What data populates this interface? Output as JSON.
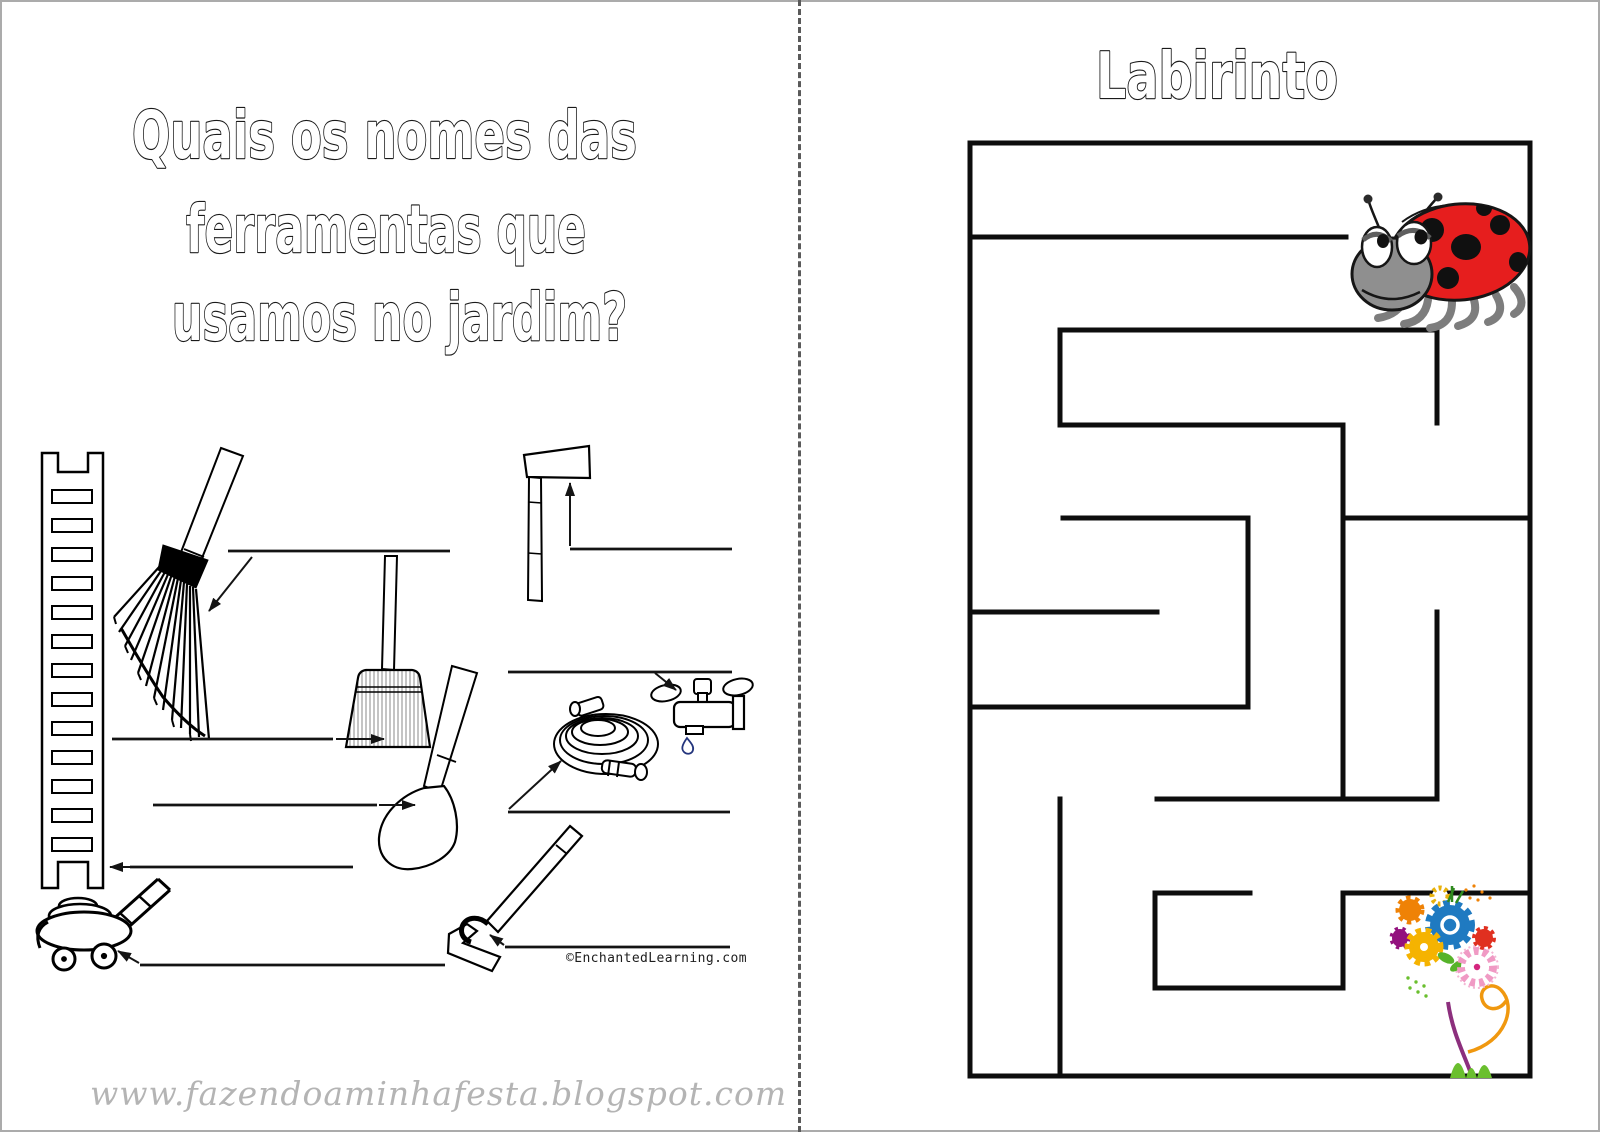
{
  "window": {
    "width": 1600,
    "height": 1132,
    "background": "#ffffff",
    "border_color": "#ababab"
  },
  "left_page": {
    "title_lines": [
      "Quais os nomes das",
      "ferramentas que",
      "usamos no jardim?"
    ],
    "credit": "©EnchantedLearning.com",
    "tools": [
      "ladder",
      "rake",
      "broom",
      "axe",
      "faucet",
      "garden-hose",
      "shovel",
      "lawn-mower",
      "hoe"
    ],
    "answer_lines": [
      {
        "tool": "rake",
        "line": [
          228,
          551,
          450,
          551
        ],
        "arrow": [
          252,
          557,
          209,
          611
        ]
      },
      {
        "tool": "axe",
        "line": [
          570,
          549,
          732,
          549
        ],
        "arrow": [
          570,
          546,
          570,
          483
        ]
      },
      {
        "tool": "faucet",
        "line": [
          508,
          672,
          732,
          672
        ],
        "arrow": [
          655,
          673,
          676,
          690
        ]
      },
      {
        "tool": "broom",
        "line": [
          112,
          739,
          333,
          739
        ],
        "arrow": [
          336,
          739,
          384,
          739
        ]
      },
      {
        "tool": "shovel",
        "line": [
          153,
          805,
          377,
          805
        ],
        "arrow": [
          379,
          805,
          415,
          805
        ]
      },
      {
        "tool": "hose",
        "line": [
          508,
          812,
          730,
          812
        ],
        "arrow": [
          509,
          809,
          561,
          761
        ]
      },
      {
        "tool": "ladder",
        "line": [
          130,
          867,
          353,
          867
        ],
        "arrow": [
          131,
          867,
          110,
          867
        ]
      },
      {
        "tool": "hoe",
        "line": [
          505,
          947,
          730,
          947
        ],
        "arrow": [
          504,
          945,
          490,
          935
        ]
      },
      {
        "tool": "mower",
        "line": [
          140,
          965,
          445,
          965
        ],
        "arrow": [
          139,
          963,
          118,
          951
        ]
      }
    ]
  },
  "right_page": {
    "title": "Labirinto",
    "start_icon": "ladybug",
    "goal_icon": "flower-bouquet",
    "maze": {
      "stroke": "#0d0d0d",
      "stroke_width": 5,
      "walls": [
        [
          970,
          143,
          1530,
          143
        ],
        [
          970,
          143,
          970,
          1076
        ],
        [
          1530,
          143,
          1530,
          1076
        ],
        [
          970,
          1076,
          1530,
          1076
        ],
        [
          970,
          237,
          1346,
          237
        ],
        [
          1060,
          330,
          1437,
          330
        ],
        [
          1060,
          330,
          1060,
          425
        ],
        [
          1437,
          330,
          1437,
          423
        ],
        [
          1060,
          425,
          1343,
          425
        ],
        [
          1343,
          425,
          1343,
          799
        ],
        [
          1343,
          518,
          1530,
          518
        ],
        [
          1063,
          518,
          1248,
          518
        ],
        [
          1248,
          518,
          1248,
          707
        ],
        [
          970,
          612,
          1157,
          612
        ],
        [
          970,
          707,
          1248,
          707
        ],
        [
          1437,
          612,
          1437,
          799
        ],
        [
          1157,
          799,
          1437,
          799
        ],
        [
          1060,
          799,
          1060,
          1076
        ],
        [
          1155,
          893,
          1250,
          893
        ],
        [
          1155,
          893,
          1155,
          988
        ],
        [
          1155,
          988,
          1343,
          988
        ],
        [
          1343,
          893,
          1343,
          988
        ],
        [
          1343,
          893,
          1530,
          893
        ]
      ]
    },
    "colors": {
      "ladybug_red": "#e61e1e",
      "ladybug_gray": "#8f8f8f",
      "flower_blue": "#1f7ac1",
      "flower_orange": "#ef8206",
      "flower_yellow": "#f5b301",
      "flower_red": "#e03020",
      "flower_purple": "#93117e",
      "flower_pink": "#f09ac4",
      "stem_purple": "#8c2f7d",
      "grass_green": "#6abf2e",
      "swirl_orange": "#f0980f"
    }
  },
  "footer": {
    "watermark": "www.fazendoaminhafesta.blogspot.com",
    "color": "#b4b4b4"
  },
  "divider": {
    "style": "dashed",
    "color": "#5a5a5a"
  },
  "drop_blue": "#24357d"
}
